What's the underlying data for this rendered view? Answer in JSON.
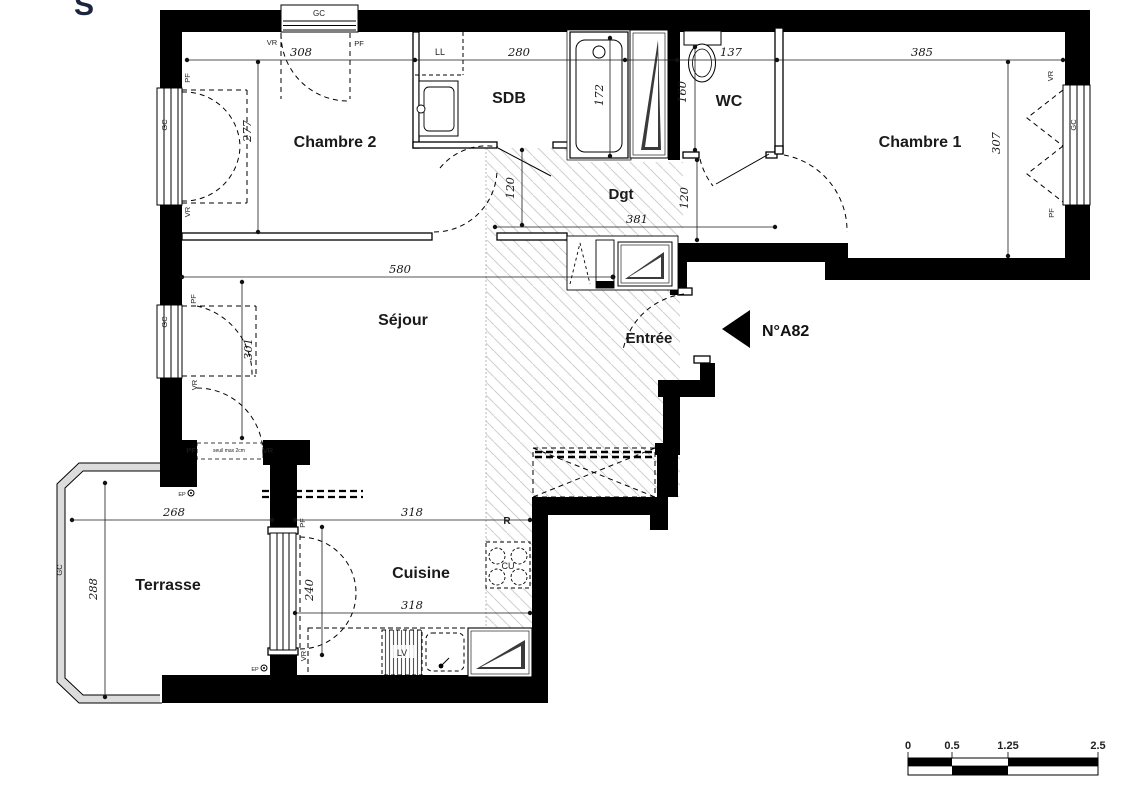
{
  "plan": {
    "corner_letter": "S",
    "unit_label": "N°A82",
    "rooms": {
      "chambre2": "Chambre 2",
      "sdb": "SDB",
      "wc": "WC",
      "chambre1": "Chambre 1",
      "dgt": "Dgt",
      "sejour": "Séjour",
      "entree": "Entrée",
      "terrasse": "Terrasse",
      "cuisine": "Cuisine"
    },
    "dims": {
      "d308": "308",
      "d280": "280",
      "d137": "137",
      "d385": "385",
      "d277": "277",
      "d172": "172",
      "d160": "160",
      "d307": "307",
      "d120a": "120",
      "d120b": "120",
      "d381": "381",
      "d580": "580",
      "d301": "301",
      "d268": "268",
      "d288": "288",
      "d240": "240",
      "d318a": "318",
      "d318b": "318"
    },
    "tags": {
      "vr": "VR",
      "pf": "PF",
      "gc": "GC",
      "ll": "LL",
      "cu": "CU",
      "lv": "LV",
      "r": "R",
      "ep": "EP",
      "seuil": "seuil max 2cm"
    },
    "scale_bar": {
      "t0": "0",
      "t1": "0.5",
      "t2": "1.25",
      "t3": "2.5"
    },
    "colors": {
      "wall": "#000000",
      "label_text": "#1a1a1a",
      "hatch": "#cfcfcf",
      "corner_letter": "#1c2540",
      "wedge": "#3a3a3a"
    }
  }
}
